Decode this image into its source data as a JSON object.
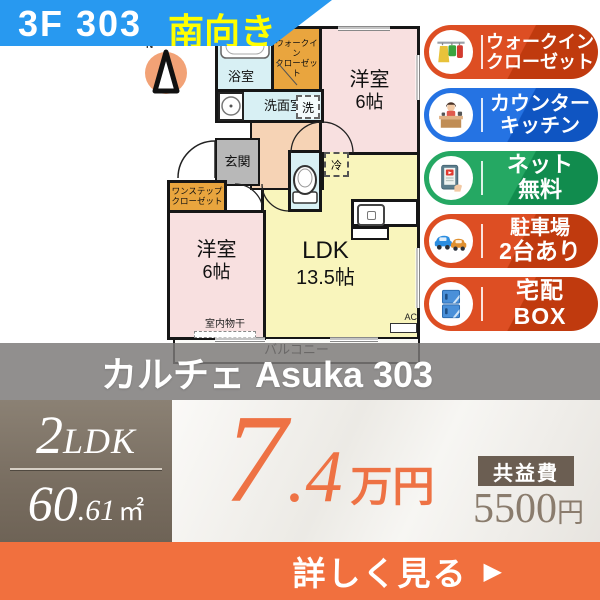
{
  "header": {
    "unit": "3F 303",
    "facing": "南向き"
  },
  "compass": {
    "north": "N"
  },
  "floor_plan": {
    "bath": "浴室",
    "walkin": {
      "line1": "ウォークイン",
      "line2": "クローゼット"
    },
    "west_upper": {
      "name": "洋室",
      "size": "6帖"
    },
    "washroom": "洗面室",
    "washer": "洗",
    "entrance": "玄関",
    "onestep": {
      "line1": "ワンステップ",
      "line2": "クローゼット"
    },
    "west_lower": {
      "name": "洋室",
      "size": "6帖"
    },
    "fridge": "冷",
    "ldk": {
      "name": "LDK",
      "size": "13.5帖"
    },
    "indoor_drying": "室内物干",
    "ac": "AC",
    "balcony": "バルコニー"
  },
  "badges": [
    {
      "line1": "ウォークイン",
      "line2": "クローゼット",
      "color": "#d0441a",
      "icon": "walk-in-closet"
    },
    {
      "line1": "カウンター",
      "line2": "キッチン",
      "color": "#1a64d4",
      "icon": "counter-kitchen"
    },
    {
      "line1": "ネット",
      "line2": "無料",
      "color": "#1b9a58",
      "icon": "free-internet"
    },
    {
      "line1": "駐車場",
      "line2": "2台あり",
      "color": "#d0441a",
      "icon": "parking"
    },
    {
      "line1": "宅配",
      "line2": "BOX",
      "color": "#d0441a",
      "icon": "delivery-box"
    }
  ],
  "property": {
    "name": "カルチェ Asuka 303"
  },
  "summary": {
    "layout_num": "2",
    "layout_type": "LDK",
    "area_whole": "60",
    "area_frac": ".61",
    "area_unit": "㎡",
    "rent_whole": "7",
    "rent_frac": ".4",
    "rent_unit": "万円",
    "fee_label": "共益費",
    "fee_value": "5500",
    "fee_unit": "円"
  },
  "cta": {
    "label": "詳しく見る",
    "arrow": "▶"
  },
  "colors": {
    "header_blue": "#2899f0",
    "facing_yellow": "#ffff00",
    "price_orange": "#ee7244",
    "cta_orange": "#f1703e",
    "spec_taupe": "#786d60",
    "overlay_gray": "#7c7a78"
  }
}
